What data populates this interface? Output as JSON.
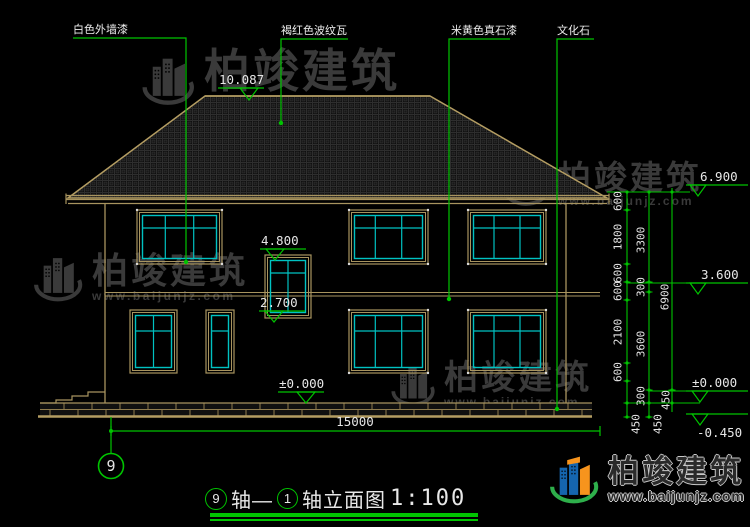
{
  "materials": {
    "wall_paint": "白色外墙漆",
    "roof_tile": "褐红色波纹瓦",
    "stone_paint": "米黄色真石漆",
    "culture_stone": "文化石"
  },
  "levels": {
    "ridge": "10.087",
    "stair_win_top": "4.800",
    "stair_win_btm": "2.700",
    "eave": "6.900",
    "second_floor": "3.600",
    "zero_center": "±0.000",
    "zero_right": "±0.000",
    "ground": "-0.450"
  },
  "dims": {
    "col1": [
      "600",
      "1800",
      "600",
      "600",
      "2100",
      "600"
    ],
    "col2": [
      "3300",
      "300",
      "3600",
      "300"
    ],
    "col3": [
      "6900",
      "450"
    ],
    "plinth_450s": [
      "450",
      "450"
    ],
    "total_width": "15000"
  },
  "axis": {
    "bubble": "9"
  },
  "title": {
    "axis_from": "9",
    "joiner": "轴—",
    "axis_to": "1",
    "suffix": "轴立面图",
    "scale": "1:100"
  },
  "brand": {
    "name": "柏竣建筑",
    "site": "www.baijunjz.com"
  },
  "colors": {
    "line_tan": "#a8945f",
    "window_cyan": "#00c2c2",
    "dim_green": "#00c400",
    "text_white": "#e6e6e6",
    "watermark_gray": "#3a3a3a",
    "logo_blue": "#1565ae",
    "logo_orange": "#f7941d",
    "logo_green": "#2eaf4b"
  }
}
